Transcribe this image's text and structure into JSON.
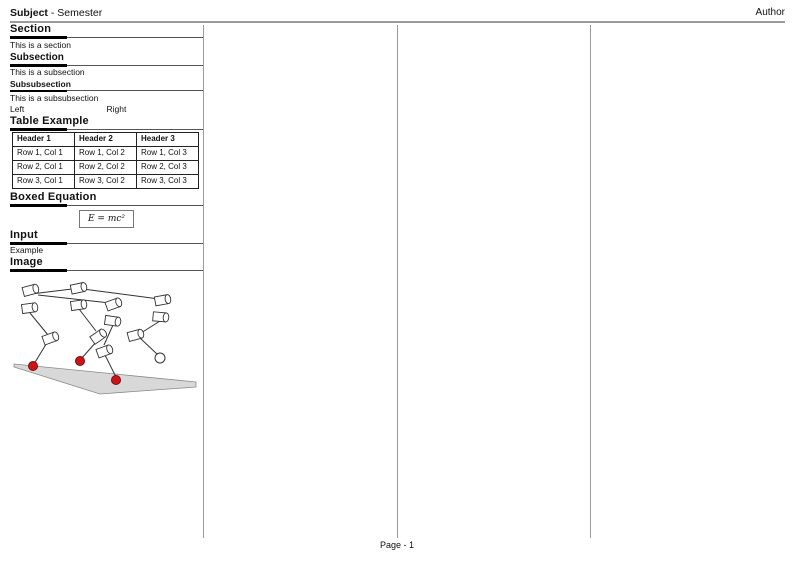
{
  "header": {
    "subject": "Subject",
    "rest": "- Semester",
    "author": "Author"
  },
  "footer": {
    "page_label": "Page - 1"
  },
  "sections": {
    "section": {
      "title": "Section",
      "body": "This is a section"
    },
    "subsection": {
      "title": "Subsection",
      "body": "This is a subsection"
    },
    "subsubsection": {
      "title": "Subsubsection",
      "body": "This is a subsubsection"
    },
    "columns_demo": {
      "left": "Left",
      "right": "Right"
    },
    "table_example": {
      "title": "Table Example",
      "headers": [
        "Header 1",
        "Header 2",
        "Header 3"
      ],
      "rows": [
        [
          "Row 1, Col 1",
          "Row 1, Col 2",
          "Row 1, Col 3"
        ],
        [
          "Row 2, Col 1",
          "Row 2, Col 2",
          "Row 2, Col 3"
        ],
        [
          "Row 3, Col 1",
          "Row 3, Col 2",
          "Row 3, Col 3"
        ]
      ]
    },
    "boxed_equation": {
      "title": "Boxed Equation",
      "equation": "E = mc²"
    },
    "input": {
      "title": "Input",
      "body": "Example"
    },
    "image": {
      "title": "Image"
    }
  },
  "colors": {
    "rule_gray": "#9b9b9b",
    "thin_rule": "#555555",
    "heading_bar": "#000000",
    "table_border": "#222222",
    "figure_stroke": "#333333",
    "ground_fill": "#d8d8d8",
    "ground_stroke": "#8a8a8a",
    "foot_red": "#cc1418",
    "foot_red_stroke": "#7a0c10"
  },
  "figure": {
    "width": 193,
    "height": 126,
    "ground": [
      [
        4,
        92
      ],
      [
        186,
        110
      ],
      [
        186,
        115
      ],
      [
        90,
        122
      ],
      [
        4,
        95
      ]
    ],
    "cylinders": [
      [
        21,
        18,
        -15
      ],
      [
        20,
        36,
        -8
      ],
      [
        69,
        16,
        -12
      ],
      [
        69,
        33,
        -8
      ],
      [
        104,
        32,
        -20
      ],
      [
        103,
        49,
        8
      ],
      [
        153,
        28,
        -10
      ],
      [
        151,
        45,
        5
      ],
      [
        41,
        66,
        -20
      ],
      [
        89,
        64,
        -35
      ],
      [
        95,
        79,
        -20
      ],
      [
        126,
        63,
        -15
      ]
    ],
    "links": [
      [
        21,
        22,
        62,
        17
      ],
      [
        73,
        17,
        149,
        27
      ],
      [
        28,
        23,
        100,
        31
      ],
      [
        20,
        41,
        38,
        63
      ],
      [
        38,
        69,
        24,
        92
      ],
      [
        69,
        37,
        86,
        59
      ],
      [
        87,
        69,
        71,
        87
      ],
      [
        103,
        53,
        94,
        73
      ],
      [
        95,
        83,
        106,
        105
      ],
      [
        150,
        49,
        131,
        61
      ],
      [
        130,
        66,
        148,
        83
      ]
    ],
    "feet": [
      [
        23,
        94
      ],
      [
        70,
        89
      ],
      [
        106,
        108
      ]
    ],
    "foot_radius": 4.5,
    "ball": [
      150,
      86,
      5
    ]
  }
}
